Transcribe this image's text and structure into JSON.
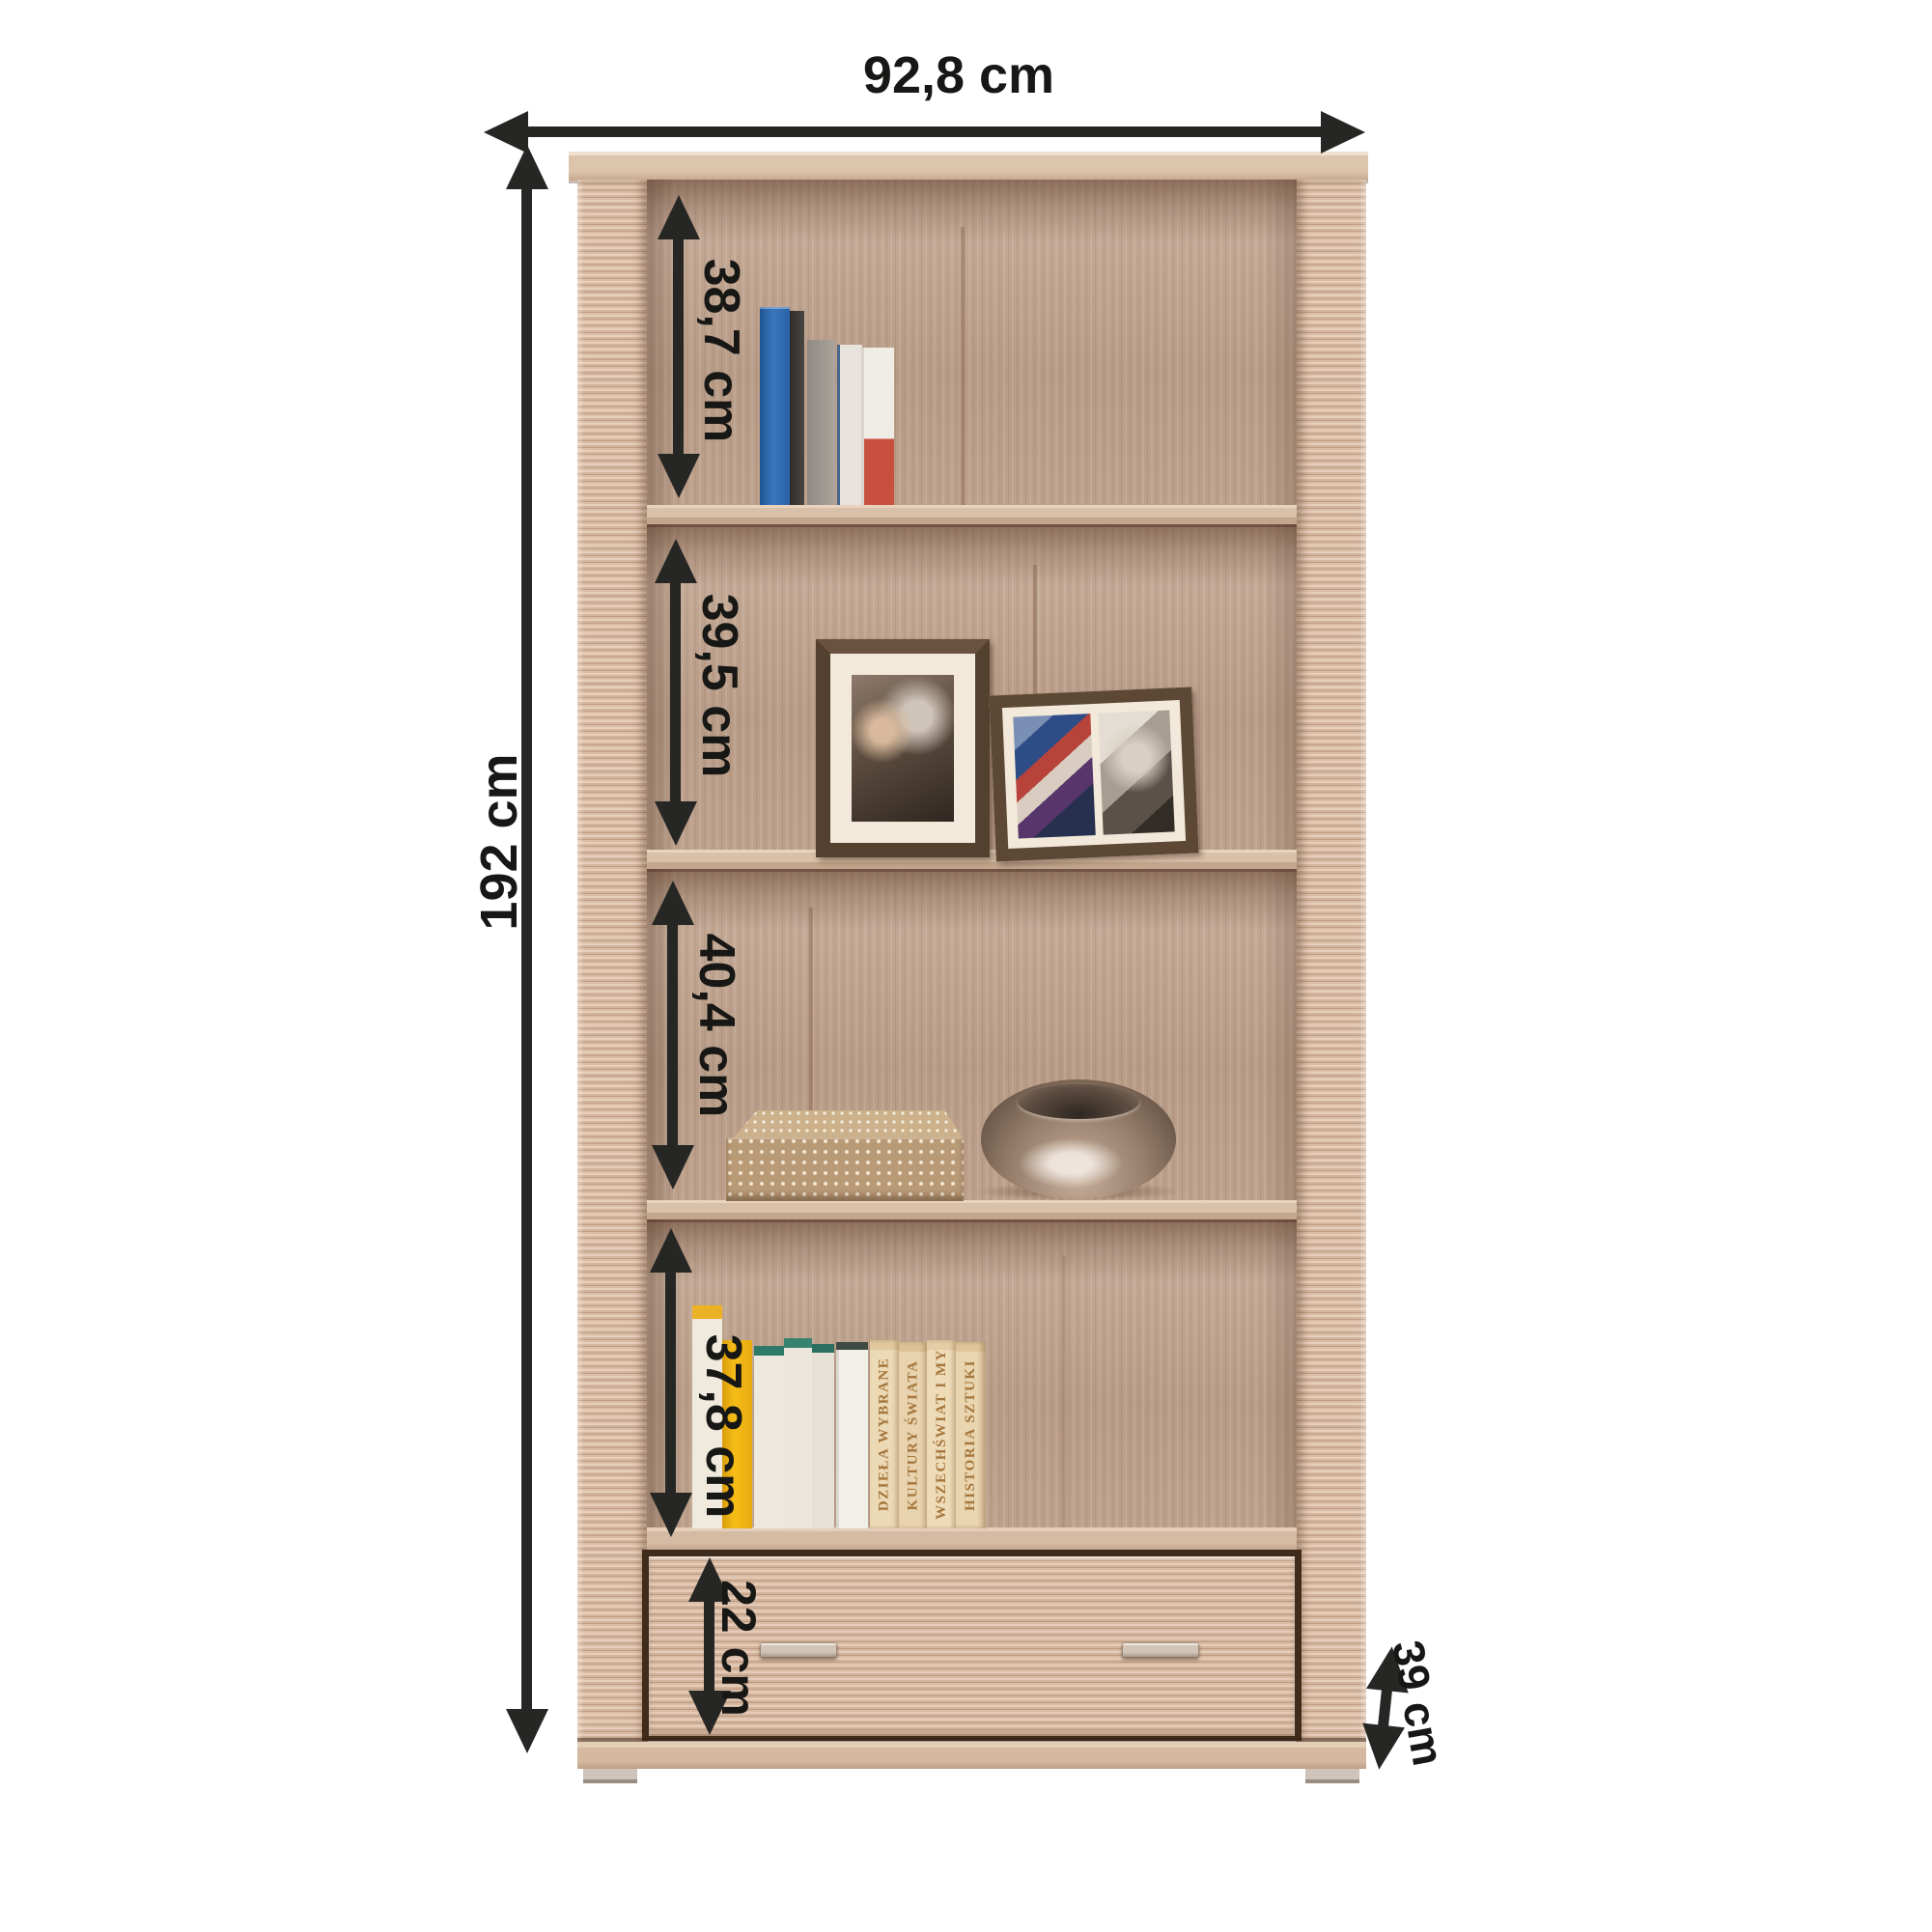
{
  "diagram": {
    "type": "furniture-dimension-diagram",
    "item": "bookcase with bottom drawer",
    "dimensions": {
      "width": "92,8 cm",
      "height": "192 cm",
      "depth": "39 cm",
      "drawer": "22 cm",
      "compartments": [
        "38,7 cm",
        "39,5 cm",
        "40,4 cm",
        "37,8 cm"
      ]
    },
    "decor": {
      "book_spine_titles": [
        "DZIEŁA WYBRANE",
        "KULTURY ŚWIATA",
        "WSZECHŚWIAT I MY",
        "HISTORIA SZTUKI"
      ]
    },
    "colors": {
      "arrow": "#262624",
      "wood_light": "#dcc2ab",
      "wood_ribbed": "#d3b59e",
      "wood_back_panel": "#b79b86",
      "background": "#ffffff"
    }
  }
}
